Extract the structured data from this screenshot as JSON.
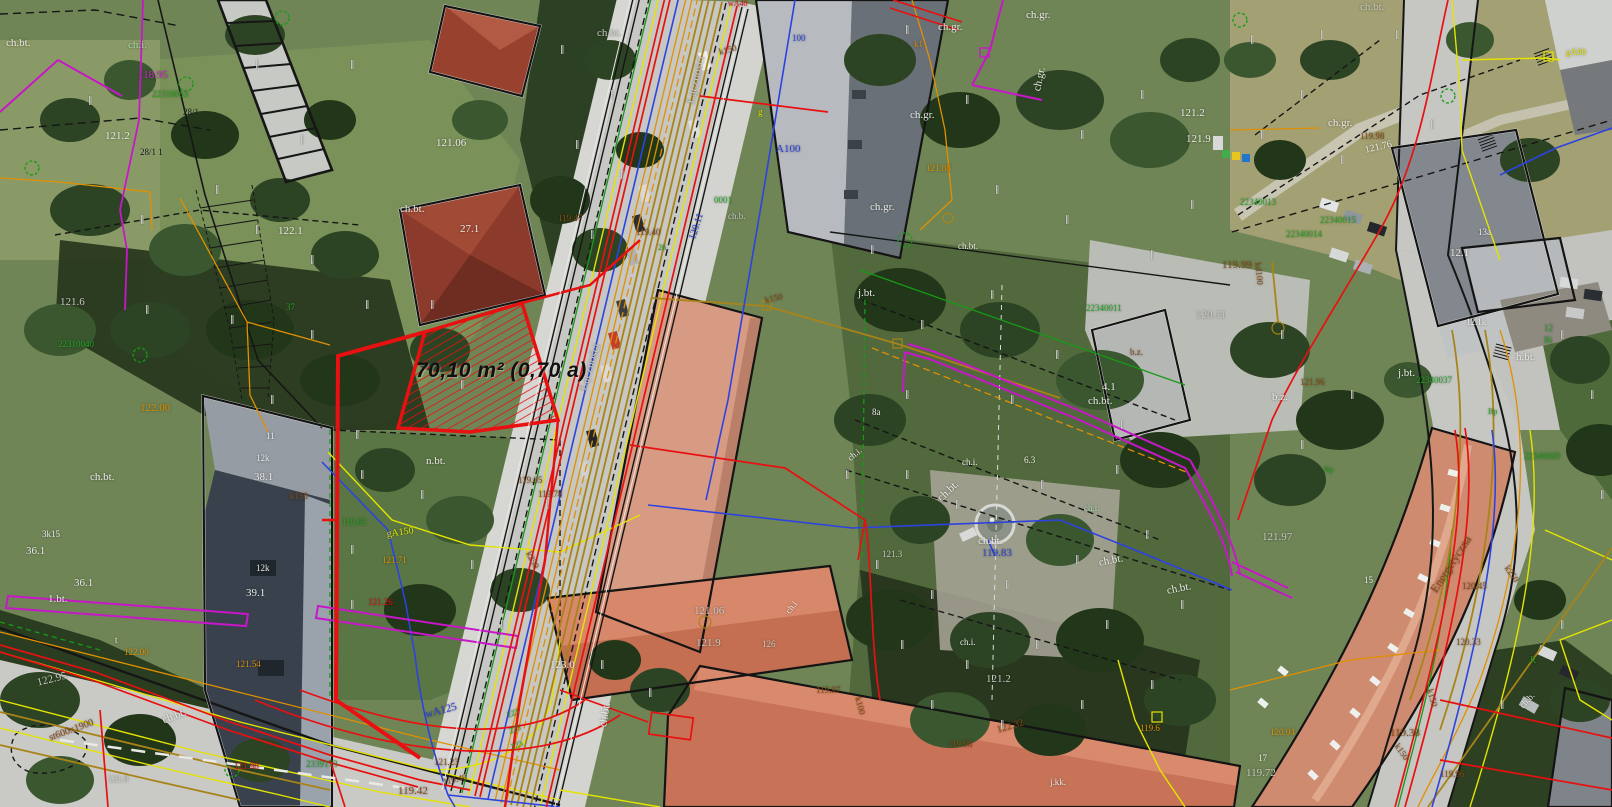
{
  "map": {
    "type": "cadastral-utility-overlay-on-orthophoto",
    "highlight": {
      "area_label": "70,10 m² (0,70 a)",
      "color": "#e81010"
    },
    "street_names": [
      "Łączności",
      "Energetyczna"
    ],
    "palette": {
      "w": "#ecece8",
      "gy": "#c9c9c2",
      "g": "#23a523",
      "gp": "#a5d8a6",
      "br": "#8a4a14",
      "or": "#e09000",
      "yl": "#e4e400",
      "bl": "#2d43e0",
      "mg": "#d81fd8",
      "rd": "#e81010",
      "bk": "#101010"
    },
    "labels": [
      {
        "t": "70,10 m² (0,70 a)",
        "x": 416,
        "y": 360,
        "c": "bk",
        "s": 21,
        "b": 1,
        "i": 1,
        "n": "area-measurement-label"
      },
      {
        "t": "ch.bt.",
        "x": 6,
        "y": 38,
        "c": "w"
      },
      {
        "t": "ch.i.",
        "x": 128,
        "y": 40,
        "c": "gp"
      },
      {
        "t": "118.95",
        "x": 138,
        "y": 70,
        "c": "mg"
      },
      {
        "t": "22310063",
        "x": 152,
        "y": 90,
        "c": "g",
        "s": 9
      },
      {
        "t": "28/1",
        "x": 183,
        "y": 108,
        "c": "bk",
        "s": 9
      },
      {
        "t": "28/1 1",
        "x": 140,
        "y": 148,
        "c": "bk",
        "s": 9
      },
      {
        "t": "121.2",
        "x": 105,
        "y": 131,
        "c": "w"
      },
      {
        "t": "121.6",
        "x": 60,
        "y": 297,
        "c": "gy"
      },
      {
        "t": "122.1",
        "x": 278,
        "y": 226,
        "c": "w"
      },
      {
        "t": "37",
        "x": 286,
        "y": 303,
        "c": "g",
        "s": 9
      },
      {
        "t": "22310040",
        "x": 58,
        "y": 340,
        "c": "g",
        "s": 9
      },
      {
        "t": "122.00",
        "x": 140,
        "y": 403,
        "c": "or"
      },
      {
        "t": "ch.bt.",
        "x": 90,
        "y": 472,
        "c": "w"
      },
      {
        "t": "3k15",
        "x": 42,
        "y": 530,
        "c": "w",
        "s": 9
      },
      {
        "t": "36.1",
        "x": 26,
        "y": 546,
        "c": "w"
      },
      {
        "t": "36.1",
        "x": 74,
        "y": 578,
        "c": "w"
      },
      {
        "t": "1.bt.",
        "x": 48,
        "y": 594,
        "c": "w"
      },
      {
        "t": "11",
        "x": 266,
        "y": 432,
        "c": "w",
        "s": 9
      },
      {
        "t": "12k",
        "x": 256,
        "y": 454,
        "c": "w",
        "s": 9
      },
      {
        "t": "38.1",
        "x": 254,
        "y": 472,
        "c": "w"
      },
      {
        "t": "12k",
        "x": 256,
        "y": 564,
        "c": "w",
        "s": 9
      },
      {
        "t": "39.1",
        "x": 246,
        "y": 588,
        "c": "w"
      },
      {
        "t": "k150",
        "x": 290,
        "y": 492,
        "c": "br",
        "s": 9
      },
      {
        "t": "119.65",
        "x": 342,
        "y": 518,
        "c": "g",
        "s": 9
      },
      {
        "t": "121.06",
        "x": 436,
        "y": 138,
        "c": "w"
      },
      {
        "t": "ch.bt.",
        "x": 400,
        "y": 204,
        "c": "w"
      },
      {
        "t": "27.1",
        "x": 460,
        "y": 224,
        "c": "w"
      },
      {
        "t": "119.47",
        "x": 558,
        "y": 214,
        "c": "br",
        "s": 9
      },
      {
        "t": "119.40",
        "x": 636,
        "y": 228,
        "c": "br",
        "s": 9
      },
      {
        "t": "26",
        "x": 658,
        "y": 244,
        "c": "g",
        "s": 8
      },
      {
        "t": "120.11",
        "x": 688,
        "y": 238,
        "c": "bl",
        "s": 10,
        "r": -72
      },
      {
        "t": "ch.bt.",
        "x": 597,
        "y": 28,
        "c": "gy"
      },
      {
        "t": "k150",
        "x": 718,
        "y": 48,
        "c": "br",
        "s": 9,
        "r": -14
      },
      {
        "t": "Łączności",
        "x": 684,
        "y": 102,
        "c": "gy",
        "s": 12,
        "r": -77
      },
      {
        "t": "Łączności",
        "x": 576,
        "y": 388,
        "c": "gy",
        "s": 12,
        "r": -72
      },
      {
        "t": "A100",
        "x": 776,
        "y": 144,
        "c": "bl"
      },
      {
        "t": "100",
        "x": 792,
        "y": 34,
        "c": "bl",
        "s": 9
      },
      {
        "t": "wA40",
        "x": 728,
        "y": 0,
        "c": "rd",
        "s": 8
      },
      {
        "t": "g",
        "x": 758,
        "y": 108,
        "c": "yl",
        "s": 9
      },
      {
        "t": "0001",
        "x": 714,
        "y": 196,
        "c": "g",
        "s": 9
      },
      {
        "t": "ch.b.",
        "x": 728,
        "y": 212,
        "c": "gy",
        "s": 9
      },
      {
        "t": "ch.gr.",
        "x": 938,
        "y": 22,
        "c": "w"
      },
      {
        "t": "ch.gr.",
        "x": 1026,
        "y": 10,
        "c": "w"
      },
      {
        "t": "ch.gr.",
        "x": 1032,
        "y": 90,
        "c": "w",
        "r": -78
      },
      {
        "t": "ch.gr.",
        "x": 910,
        "y": 110,
        "c": "w"
      },
      {
        "t": "ch.gr.",
        "x": 870,
        "y": 202,
        "c": "w"
      },
      {
        "t": "121.88",
        "x": 926,
        "y": 164,
        "c": "or",
        "s": 9
      },
      {
        "t": "k1",
        "x": 914,
        "y": 40,
        "c": "or",
        "s": 9
      },
      {
        "t": "121.2",
        "x": 1180,
        "y": 108,
        "c": "w"
      },
      {
        "t": "121.9",
        "x": 1186,
        "y": 134,
        "c": "w"
      },
      {
        "t": "22340011",
        "x": 1086,
        "y": 304,
        "c": "g",
        "s": 9
      },
      {
        "t": "120.11",
        "x": 1196,
        "y": 310,
        "c": "gy"
      },
      {
        "t": "119.99",
        "x": 1222,
        "y": 260,
        "c": "br"
      },
      {
        "t": "kd100",
        "x": 1262,
        "y": 262,
        "c": "br",
        "s": 9,
        "r": 84
      },
      {
        "t": "ch.bt.",
        "x": 1088,
        "y": 396,
        "c": "w"
      },
      {
        "t": "b.z.",
        "x": 1272,
        "y": 392,
        "c": "w"
      },
      {
        "t": "4.1",
        "x": 1102,
        "y": 382,
        "c": "w"
      },
      {
        "t": "j.bt.",
        "x": 858,
        "y": 288,
        "c": "w"
      },
      {
        "t": "8a",
        "x": 872,
        "y": 408,
        "c": "w",
        "s": 9
      },
      {
        "t": "ch.i.",
        "x": 846,
        "y": 456,
        "c": "w",
        "s": 9,
        "r": -40
      },
      {
        "t": "ch.i.",
        "x": 962,
        "y": 458,
        "c": "w",
        "s": 9
      },
      {
        "t": "6.3",
        "x": 1024,
        "y": 456,
        "c": "w",
        "s": 9
      },
      {
        "t": "ch.bt.",
        "x": 958,
        "y": 242,
        "c": "w",
        "s": 9
      },
      {
        "t": "b.z.",
        "x": 1130,
        "y": 348,
        "c": "br",
        "s": 9
      },
      {
        "t": "k150",
        "x": 764,
        "y": 296,
        "c": "br",
        "s": 9,
        "r": -12
      },
      {
        "t": "ch.bt.",
        "x": 1360,
        "y": 2,
        "c": "gy"
      },
      {
        "t": "ch.gr.",
        "x": 1328,
        "y": 118,
        "c": "w"
      },
      {
        "t": "119.98",
        "x": 1360,
        "y": 132,
        "c": "br",
        "s": 9
      },
      {
        "t": "121.76",
        "x": 1364,
        "y": 146,
        "c": "w",
        "s": 10,
        "r": -13
      },
      {
        "t": "22340013",
        "x": 1240,
        "y": 198,
        "c": "g",
        "s": 9
      },
      {
        "t": "22340015",
        "x": 1320,
        "y": 216,
        "c": "g",
        "s": 9
      },
      {
        "t": "22340014",
        "x": 1286,
        "y": 230,
        "c": "g",
        "s": 9
      },
      {
        "t": "13a",
        "x": 1478,
        "y": 228,
        "c": "w",
        "s": 9
      },
      {
        "t": "gA80",
        "x": 1566,
        "y": 48,
        "c": "yl",
        "s": 9
      },
      {
        "t": "12.1",
        "x": 1450,
        "y": 248,
        "c": "w"
      },
      {
        "t": "12.1k",
        "x": 1466,
        "y": 318,
        "c": "w",
        "s": 9
      },
      {
        "t": "12",
        "x": 1544,
        "y": 324,
        "c": "g",
        "s": 9
      },
      {
        "t": "Bi",
        "x": 1544,
        "y": 336,
        "c": "g",
        "s": 9
      },
      {
        "t": "h.bt.",
        "x": 1516,
        "y": 352,
        "c": "w"
      },
      {
        "t": "j.bt.",
        "x": 1398,
        "y": 368,
        "c": "w"
      },
      {
        "t": "22340037",
        "x": 1416,
        "y": 376,
        "c": "g",
        "s": 9
      },
      {
        "t": "121.96",
        "x": 1300,
        "y": 378,
        "c": "br",
        "s": 9
      },
      {
        "t": "22340069",
        "x": 1524,
        "y": 452,
        "c": "g",
        "s": 9
      },
      {
        "t": "Bp",
        "x": 1488,
        "y": 408,
        "c": "g",
        "s": 8
      },
      {
        "t": "Bp",
        "x": 1324,
        "y": 466,
        "c": "g",
        "s": 8
      },
      {
        "t": "121.97",
        "x": 1262,
        "y": 532,
        "c": "gy"
      },
      {
        "t": "15",
        "x": 1364,
        "y": 576,
        "c": "w",
        "s": 9
      },
      {
        "t": "17",
        "x": 1258,
        "y": 754,
        "c": "w",
        "s": 9
      },
      {
        "t": "119.72",
        "x": 1246,
        "y": 768,
        "c": "gy"
      },
      {
        "t": "120.94",
        "x": 1270,
        "y": 728,
        "c": "or",
        "s": 9
      },
      {
        "t": "119.38",
        "x": 1390,
        "y": 728,
        "c": "br"
      },
      {
        "t": "k150",
        "x": 1400,
        "y": 742,
        "c": "br",
        "s": 9,
        "r": 55
      },
      {
        "t": "k150",
        "x": 1434,
        "y": 688,
        "c": "br",
        "s": 9,
        "r": 75
      },
      {
        "t": "k250",
        "x": 1510,
        "y": 564,
        "c": "br",
        "s": 9,
        "r": 55
      },
      {
        "t": "Energetyczna",
        "x": 1428,
        "y": 588,
        "c": "br",
        "s": 12,
        "r": -57
      },
      {
        "t": "120.45",
        "x": 1462,
        "y": 582,
        "c": "br",
        "s": 9
      },
      {
        "t": "120.33",
        "x": 1456,
        "y": 638,
        "c": "br",
        "s": 9
      },
      {
        "t": "119.96",
        "x": 1440,
        "y": 770,
        "c": "br",
        "s": 9
      },
      {
        "t": "R",
        "x": 1530,
        "y": 656,
        "c": "g",
        "s": 9
      },
      {
        "t": "ch.b.",
        "x": 1518,
        "y": 704,
        "c": "w",
        "s": 9,
        "r": -47
      },
      {
        "t": "ch.bt.",
        "x": 936,
        "y": 496,
        "c": "w",
        "r": -44
      },
      {
        "t": "ch.i.",
        "x": 1084,
        "y": 504,
        "c": "gp",
        "s": 9
      },
      {
        "t": "ch.bt.",
        "x": 978,
        "y": 536,
        "c": "w"
      },
      {
        "t": "119.83",
        "x": 982,
        "y": 548,
        "c": "bl"
      },
      {
        "t": "121.3",
        "x": 882,
        "y": 550,
        "c": "gy",
        "s": 9
      },
      {
        "t": "ch.bt.",
        "x": 1098,
        "y": 558,
        "c": "w",
        "r": -11
      },
      {
        "t": "ch.bt.",
        "x": 1166,
        "y": 586,
        "c": "w",
        "r": -11
      },
      {
        "t": "ch.i.",
        "x": 960,
        "y": 638,
        "c": "w",
        "s": 9
      },
      {
        "t": "121.2",
        "x": 986,
        "y": 674,
        "c": "gy"
      },
      {
        "t": "119.97",
        "x": 816,
        "y": 686,
        "c": "br",
        "s": 9
      },
      {
        "t": "k100",
        "x": 862,
        "y": 696,
        "c": "br",
        "s": 9,
        "r": 76
      },
      {
        "t": "122.32",
        "x": 996,
        "y": 726,
        "c": "br",
        "s": 10,
        "r": -16
      },
      {
        "t": "119.98",
        "x": 948,
        "y": 740,
        "c": "br",
        "s": 9
      },
      {
        "t": "j.kk.",
        "x": 1050,
        "y": 778,
        "c": "w",
        "s": 9
      },
      {
        "t": "119.6",
        "x": 1140,
        "y": 724,
        "c": "or",
        "s": 9
      },
      {
        "t": "121.06",
        "x": 694,
        "y": 606,
        "c": "gy"
      },
      {
        "t": "121.9",
        "x": 696,
        "y": 638,
        "c": "gy"
      },
      {
        "t": "126",
        "x": 762,
        "y": 640,
        "c": "gy",
        "s": 9
      },
      {
        "t": "ch.i",
        "x": 784,
        "y": 610,
        "c": "w",
        "s": 9,
        "r": -52
      },
      {
        "t": "123.0",
        "x": 550,
        "y": 660,
        "c": "w"
      },
      {
        "t": "ch.bt.",
        "x": 598,
        "y": 726,
        "c": "w",
        "r": -80
      },
      {
        "t": "wA125",
        "x": 424,
        "y": 710,
        "c": "bl",
        "s": 11,
        "r": -15
      },
      {
        "t": "119.42",
        "x": 398,
        "y": 786,
        "c": "br"
      },
      {
        "t": "119.49",
        "x": 442,
        "y": 778,
        "c": "br",
        "s": 9,
        "r": -12
      },
      {
        "t": "121.23",
        "x": 434,
        "y": 758,
        "c": "br",
        "s": 9
      },
      {
        "t": "2339173",
        "x": 306,
        "y": 760,
        "c": "g",
        "s": 9
      },
      {
        "t": "223",
        "x": 506,
        "y": 712,
        "c": "g",
        "s": 8,
        "r": -21
      },
      {
        "t": "225",
        "x": 508,
        "y": 728,
        "c": "g",
        "s": 8,
        "r": -21
      },
      {
        "t": "223",
        "x": 510,
        "y": 744,
        "c": "g",
        "s": 8,
        "r": -21
      },
      {
        "t": "n.bt.",
        "x": 426,
        "y": 456,
        "c": "w"
      },
      {
        "t": "119.05",
        "x": 518,
        "y": 476,
        "c": "br",
        "s": 9
      },
      {
        "t": "119.78",
        "x": 538,
        "y": 490,
        "c": "br",
        "s": 9
      },
      {
        "t": "gA150",
        "x": 386,
        "y": 530,
        "c": "yl",
        "s": 10,
        "r": -8
      },
      {
        "t": "121.71",
        "x": 382,
        "y": 556,
        "c": "or",
        "s": 9
      },
      {
        "t": "121.26",
        "x": 368,
        "y": 598,
        "c": "rd",
        "s": 9
      },
      {
        "t": "k250",
        "x": 532,
        "y": 550,
        "c": "br",
        "s": 9,
        "r": 62
      },
      {
        "t": "122.95",
        "x": 36,
        "y": 678,
        "c": "gy",
        "r": -14
      },
      {
        "t": "ch.bt.",
        "x": 161,
        "y": 716,
        "c": "w",
        "r": -21
      },
      {
        "t": "121.98",
        "x": 234,
        "y": 762,
        "c": "rd",
        "s": 9
      },
      {
        "t": "121.54",
        "x": 236,
        "y": 660,
        "c": "or",
        "s": 9
      },
      {
        "t": "122.00",
        "x": 124,
        "y": 648,
        "c": "or",
        "s": 9
      },
      {
        "t": "st600x1900",
        "x": 48,
        "y": 734,
        "c": "br",
        "s": 10,
        "r": -20
      },
      {
        "t": "121.0",
        "x": 108,
        "y": 775,
        "c": "gy",
        "s": 9
      },
      {
        "t": "t",
        "x": 115,
        "y": 636,
        "c": "w",
        "s": 9
      }
    ],
    "tree_marks": [
      [
        88,
        96
      ],
      [
        255,
        60
      ],
      [
        350,
        60
      ],
      [
        300,
        135
      ],
      [
        215,
        185
      ],
      [
        140,
        215
      ],
      [
        255,
        225
      ],
      [
        310,
        255
      ],
      [
        145,
        305
      ],
      [
        230,
        315
      ],
      [
        310,
        330
      ],
      [
        365,
        300
      ],
      [
        430,
        300
      ],
      [
        460,
        380
      ],
      [
        355,
        430
      ],
      [
        270,
        395
      ],
      [
        560,
        45
      ],
      [
        610,
        90
      ],
      [
        575,
        140
      ],
      [
        620,
        170
      ],
      [
        590,
        230
      ],
      [
        905,
        25
      ],
      [
        965,
        95
      ],
      [
        1080,
        130
      ],
      [
        1140,
        90
      ],
      [
        995,
        185
      ],
      [
        1065,
        215
      ],
      [
        870,
        245
      ],
      [
        920,
        320
      ],
      [
        990,
        290
      ],
      [
        1055,
        350
      ],
      [
        1150,
        250
      ],
      [
        1190,
        200
      ],
      [
        905,
        390
      ],
      [
        1010,
        395
      ],
      [
        1120,
        420
      ],
      [
        845,
        470
      ],
      [
        905,
        470
      ],
      [
        955,
        500
      ],
      [
        1040,
        480
      ],
      [
        1115,
        465
      ],
      [
        875,
        560
      ],
      [
        930,
        590
      ],
      [
        1005,
        580
      ],
      [
        1075,
        555
      ],
      [
        1145,
        530
      ],
      [
        900,
        640
      ],
      [
        965,
        660
      ],
      [
        1035,
        640
      ],
      [
        1105,
        620
      ],
      [
        1180,
        600
      ],
      [
        930,
        700
      ],
      [
        1000,
        720
      ],
      [
        1080,
        700
      ],
      [
        1150,
        680
      ],
      [
        1250,
        35
      ],
      [
        1320,
        30
      ],
      [
        1395,
        30
      ],
      [
        1300,
        90
      ],
      [
        1260,
        130
      ],
      [
        1340,
        155
      ],
      [
        1430,
        120
      ],
      [
        1280,
        330
      ],
      [
        1350,
        390
      ],
      [
        1300,
        440
      ],
      [
        1560,
        330
      ],
      [
        1590,
        390
      ],
      [
        1600,
        490
      ],
      [
        360,
        470
      ],
      [
        420,
        490
      ],
      [
        470,
        560
      ],
      [
        350,
        545
      ],
      [
        350,
        600
      ],
      [
        500,
        620
      ],
      [
        545,
        500
      ],
      [
        648,
        688
      ],
      [
        600,
        660
      ],
      [
        1560,
        620
      ],
      [
        1500,
        700
      ]
    ]
  }
}
